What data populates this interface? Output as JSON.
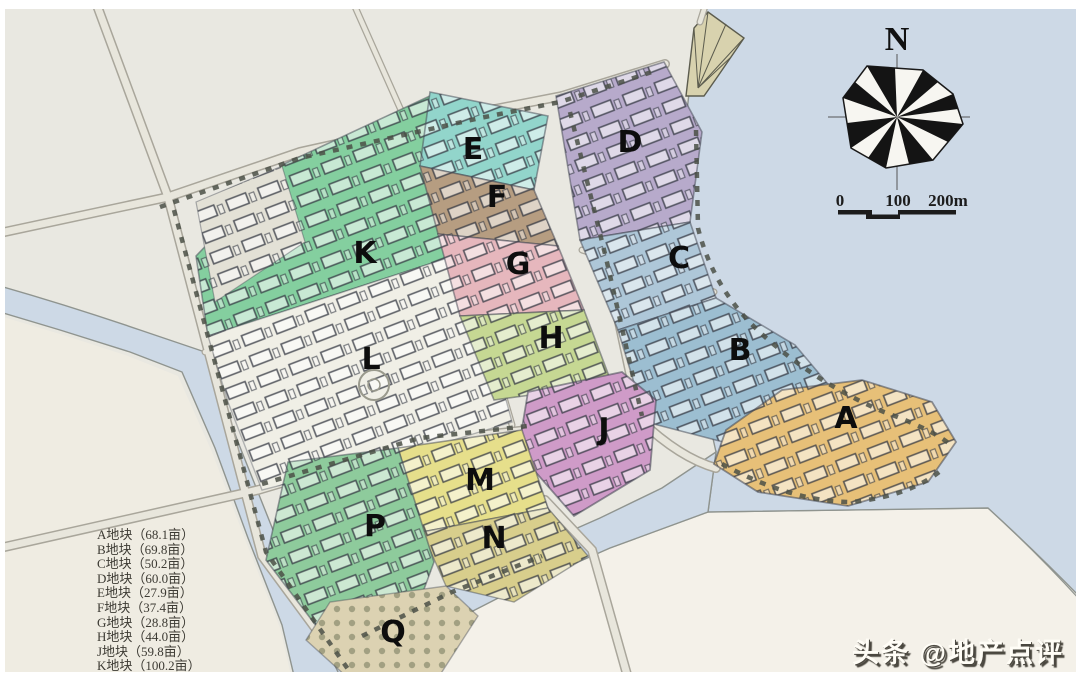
{
  "watermark": {
    "text": "头条 @地产点评"
  },
  "compass": {
    "label": "N"
  },
  "scale_bar": {
    "tick_labels": [
      "0",
      "100",
      "200m"
    ]
  },
  "legend": {
    "items": [
      "A地块（68.1亩）",
      "B地块（69.8亩）",
      "C地块（50.2亩）",
      "D地块（60.0亩）",
      "E地块（27.9亩）",
      "F地块（37.4亩）",
      "G地块（28.8亩）",
      "H地块（44.0亩）",
      "J地块（59.8亩）",
      "K地块（100.2亩）"
    ]
  },
  "parcels": [
    {
      "id": "A",
      "label": "A",
      "color": "#e7c078"
    },
    {
      "id": "B",
      "label": "B",
      "color": "#9cbed1"
    },
    {
      "id": "C",
      "label": "C",
      "color": "#aec7d8"
    },
    {
      "id": "D",
      "label": "D",
      "color": "#b7aacb"
    },
    {
      "id": "E",
      "label": "E",
      "color": "#92d5cb"
    },
    {
      "id": "F",
      "label": "F",
      "color": "#b69d81"
    },
    {
      "id": "G",
      "label": "G",
      "color": "#e6b7bd"
    },
    {
      "id": "H",
      "label": "H",
      "color": "#c6d893"
    },
    {
      "id": "J",
      "label": "J",
      "color": "#cf9bc8"
    },
    {
      "id": "K",
      "label": "K",
      "color": "#84cf9f"
    },
    {
      "id": "L",
      "label": "L",
      "color": "#f0efe6"
    },
    {
      "id": "M",
      "label": "M",
      "color": "#e6df8b"
    },
    {
      "id": "N",
      "label": "N",
      "color": "#d8ce8c"
    },
    {
      "id": "P",
      "label": "P",
      "color": "#8ecb9c"
    },
    {
      "id": "Q",
      "label": "Q",
      "color": "#dcd2b2"
    }
  ]
}
